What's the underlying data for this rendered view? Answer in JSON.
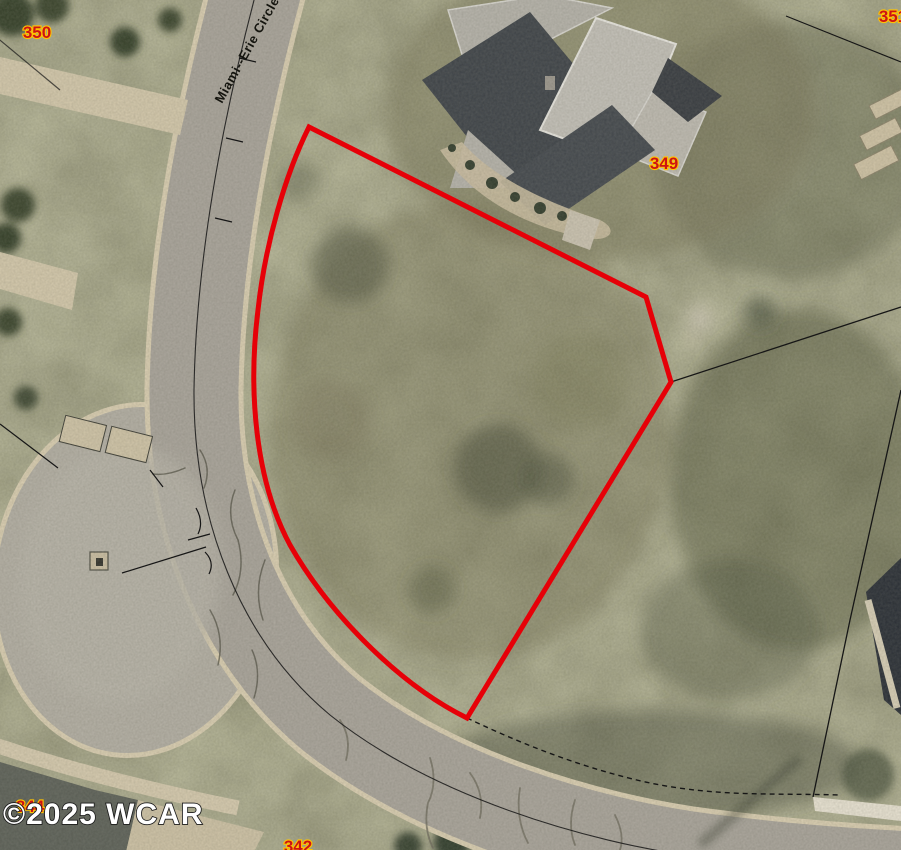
{
  "map": {
    "kind": "aerial-parcel-map",
    "street_label": "Miami--Erie Circle",
    "watermark": "©2025 WCAR",
    "parcel_labels": [
      {
        "id": "350"
      },
      {
        "id": "351"
      },
      {
        "id": "349"
      },
      {
        "id": "344"
      },
      {
        "id": "342"
      }
    ],
    "colors": {
      "parcel_outline": "#e60008",
      "parcel_label_fill": "#cc1414",
      "parcel_label_halo": "#ffc400",
      "road_asphalt": "#a7a299",
      "culdesac_asphalt": "#b1ada2",
      "curb": "#d9cdb0",
      "grass_base": "#6a6a4f",
      "watermark_fill": "#ffffff",
      "boundary_line": "#161616"
    }
  }
}
